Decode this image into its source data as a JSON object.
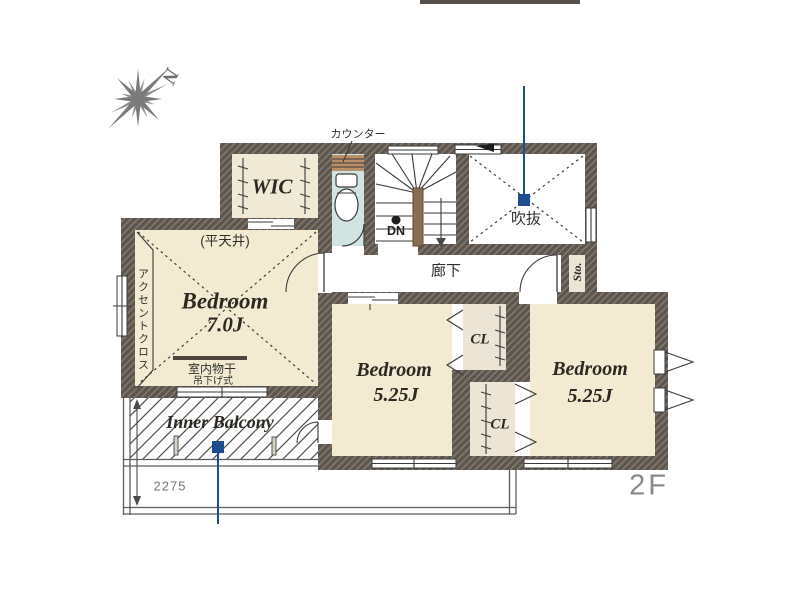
{
  "colors": {
    "wall": "#5e564d",
    "wic_floor": "#f0e9d6",
    "bedroom_floor": "#f2ebd2",
    "closet_floor": "#ece4d4",
    "toilet_floor": "#d2e4e2",
    "counter": "#b98f68",
    "stair_rail": "#8a6e52",
    "annotation_blue": "#1d4d8e",
    "line": "#3a3a3a",
    "label_dark": "#2d2822",
    "label_gray": "#8a8a8a",
    "dim_gray": "#757575",
    "banner": "#55504b"
  },
  "compass": {
    "label": "N"
  },
  "floor_label": "2F",
  "rooms": {
    "wic": {
      "label": "WIC"
    },
    "toilet": {
      "counter_label": "カウンター"
    },
    "stairs": {
      "down_label": "DN"
    },
    "void_space": {
      "label": "吹抜"
    },
    "hallway": {
      "label": "廊下"
    },
    "storage": {
      "label": "Sto."
    },
    "bedroom_main": {
      "label": "Bedroom",
      "size": "7.0J",
      "ceiling_note": "(平天井)",
      "accent_wall_note": "アクセントクロス",
      "laundry_note_line1": "室内物干",
      "laundry_note_line2": "吊下げ式"
    },
    "bedroom_middle": {
      "label": "Bedroom",
      "size": "5.25J"
    },
    "bedroom_right": {
      "label": "Bedroom",
      "size": "5.25J"
    },
    "closet_upper": {
      "label": "CL"
    },
    "closet_lower": {
      "label": "CL"
    },
    "inner_balcony": {
      "label": "Inner Balcony",
      "depth_dimension": "2275"
    }
  }
}
